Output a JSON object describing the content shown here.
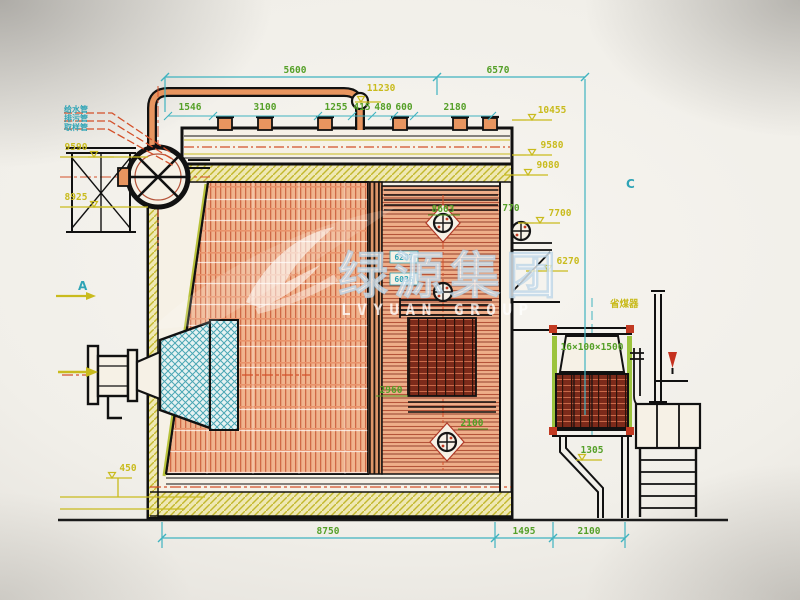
{
  "watermark": {
    "logo": "swoosh-icon",
    "cn": "绿源集团",
    "en": "LVYUAN GROUP"
  },
  "dims": {
    "top_left": "5600",
    "top_right": "6570",
    "chain": [
      "1546",
      "3100",
      "1255",
      "415",
      "480",
      "600",
      "2180"
    ],
    "bottom": [
      "8750",
      "1495",
      "2100"
    ]
  },
  "elevations": {
    "v11230": "11230",
    "v10455": "10455",
    "v9590": "9590",
    "v9580": "9580",
    "v9080": "9080",
    "v8925": "8925",
    "v8603": "8603",
    "v7700": "7700",
    "v6270": "6270",
    "v2960": "2960",
    "v2100": "2100",
    "v1305": "1305",
    "v770": "770",
    "v450": "450"
  },
  "tags": {
    "upper_box": "6287",
    "lower_box": "6036",
    "economizer_spec": "16×100×1500",
    "economizer": "省煤器",
    "view_a": "A",
    "view_c": "C"
  },
  "pipe_labels": [
    "给水管",
    "排污管",
    "取样管"
  ]
}
